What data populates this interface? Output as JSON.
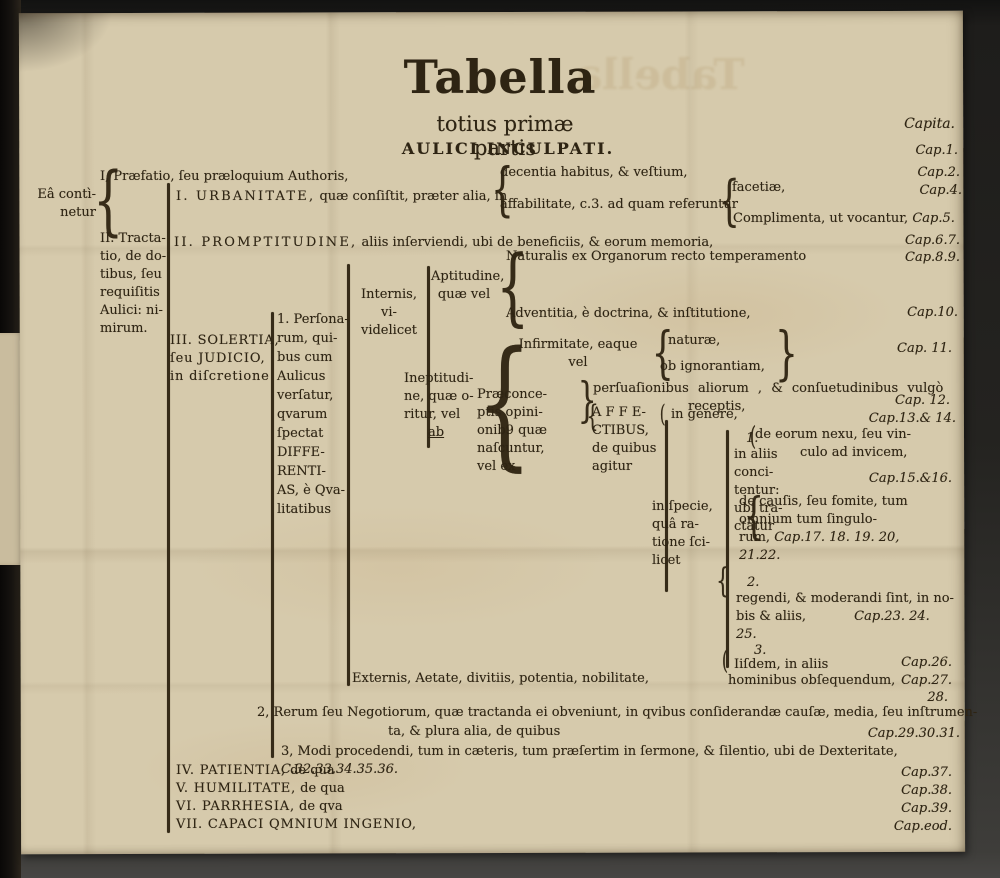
{
  "colors": {
    "paper": "#d6caac",
    "ink": "#2e2413"
  },
  "glyphs": {
    "open_brace": "{",
    "close_brace": "}",
    "open_paren": "("
  },
  "page": {
    "title": "Tabella",
    "subtitle": "totius primæ partis",
    "heading": "AULICI INCULPATI."
  },
  "caps": {
    "header": "Capita.",
    "c1": "Cap.1.",
    "c2": "Cap.2.",
    "c4": "Cap.4.",
    "c67": "Cap.6.7.",
    "c89": "Cap.8.9.",
    "c10": "Cap.10.",
    "c11": "Cap. 11.",
    "c12": "Cap. 12.",
    "c1314": "Cap.13.& 14.",
    "c1516": "Cap.15.&16.",
    "c26": "Cap.26.",
    "c27": "Cap.27.",
    "c28": "28.",
    "c293031": "Cap.29.30.31.",
    "c37": "Cap.37.",
    "c38": "Cap.38.",
    "c39": "Cap.39.",
    "ceod": "Cap.eod."
  },
  "tree": {
    "ea": "Eâ contì-\nnetur",
    "praefatio": "I, Præfatio, ſeu præloquium Authoris,",
    "tractatio": "II. Tracta-\ntio, de do-\ntibus, ſeu\nrequiſitis\nAulici: ni-\nmirum.",
    "urbanitate_term": "I. URBANITATE,",
    "urbanitate_rest": " quæ conſiſtit, præter alia, in",
    "decentia": "decentia habitus, & veſtium,",
    "affabilitate": "affabilitate, c.3. ad quam referuntur",
    "facetiae": "facetiæ,",
    "complimenta": "Complimenta, ut vocantur, ",
    "cap5": "Cap.5.",
    "promptitudine_term": "II. PROMPTITUDINE,",
    "promptitudine_rest": " aliis inſerviendi, ubi de beneficiis, & eorum memoria,",
    "naturalis": "Naturalis ex Organorum recto temperamento",
    "adventitia": "Adventitia, è doctrina, & inſtitutione,",
    "solertia": "III. SOLERTIA,\nſeu JUDICIO,\nin diſcretione",
    "personarum": "1. Perſona-\nrum, qui-\nbus cum\nAulicus\nverſatur,\nqvarum\nſpectat\nDIFFE-\nRENTI-\nAS, è Qva-\nlitatibus",
    "internis": "Internis, vi-\nvidelicet",
    "aptitudine": "Aptitudine,\nquæ vel",
    "infirmitate": "Infirmitate, eaque\nvel",
    "naturae": "naturæ,",
    "obignorantiam": "ob ignorantiam,",
    "ineptitudine": "Ineptitudi-\nne, quæ o-\nritur, vel",
    "ab": "ab",
    "praeconceptis": "Præconce-\nptis opini-\nonib9 quæ\nnaſcuntur,\nvel ex",
    "persuasionibus": "perſuaſionibus aliorum , & conſuetudinibus vulgò",
    "receptis": "receptis,",
    "affectibus": "A F F E-\nCTIBUS,\nde quibus\nagitur",
    "in_genere": "in genere,",
    "num1": "1.",
    "in_aliis": "in aliis\nconci-\ntentur:\nubi tra-\nctatur",
    "de_eorum_l1": "de eorum nexu, ſeu vin-",
    "de_eorum_l2": "culo ad invicem,",
    "de_causis": "de cauſis, ſeu fomite, tum\nomnium tum ſingulo-\nrum, ",
    "de_causis_caps": "Cap.17. 18. 19. 20,\n21.22.",
    "in_specie": "in ſpecie,\nquâ ra-\ntione ſci-\nlicet",
    "num2": "2.",
    "regendi": "regendi, & moderandi ſint, in no-\nbis & aliis, ",
    "regendi_caps": "Cap.23. 24. 25.",
    "num3": "3.",
    "iisdem": "Iiſdem, in aliis",
    "hominibus": "hominibus obſequendum,",
    "externis": "Externis, Aetate, divitiis, potentia, nobilitate,",
    "rerum_l1": "2, Rerum ſeu Negotiorum, quæ tractanda ei obveniunt, in qvibus conſiderandæ cauſæ, media, ſeu inſtrumen-",
    "rerum_l2": "ta, & plura alia, de quibus",
    "modi": "3, Modi procedendi, tum in cæteris, tum præſertim in ſermone, & ſilentio, ubi de Dexteritate, ",
    "modi_caps": "C.32.33.34.35.36.",
    "patientia_term": "IV. PATIENTIA,",
    "patientia_rest": " de qua",
    "humilitate_term": "V. HUMILITATE,",
    "humilitate_rest": " de qua",
    "parrhesia_term": "VI. PARRHESIA,",
    "parrhesia_rest": " de qva",
    "capaci_term": "VII. CAPACI QMNIUM INGENIO,"
  }
}
